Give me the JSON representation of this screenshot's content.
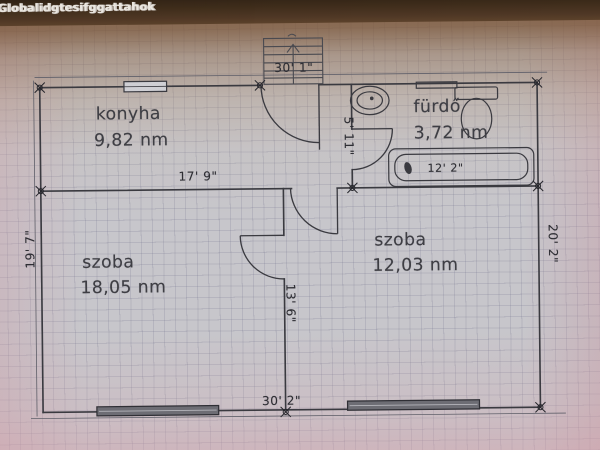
{
  "overlay": {
    "title": "Globalidgtesifggattahok"
  },
  "floorplan": {
    "rooms": {
      "kitchen": {
        "label": "konyha",
        "area": "9,82 nm"
      },
      "bathroom": {
        "label": "fürdő",
        "area": "3,72 nm"
      },
      "room1": {
        "label": "szoba",
        "area": "18,05 nm"
      },
      "room2": {
        "label": "szoba",
        "area": "12,03 nm"
      }
    },
    "dimensions": {
      "top_width": "30' 1\"",
      "bottom_width": "30' 2\"",
      "left_height": "19' 7\"",
      "right_height": "20' 2\"",
      "kitchen_width": "17' 9\"",
      "bath_wall_height": "5' 11\"",
      "divider_height": "13' 6\"",
      "bathtub_width": "12' 2\""
    },
    "colors": {
      "wall": "#3a3a40",
      "paper": "#c7c6cb",
      "top_band": "#3a2918",
      "label_text": "#3e3e44",
      "pink_tint": "#d6a6ae"
    }
  }
}
